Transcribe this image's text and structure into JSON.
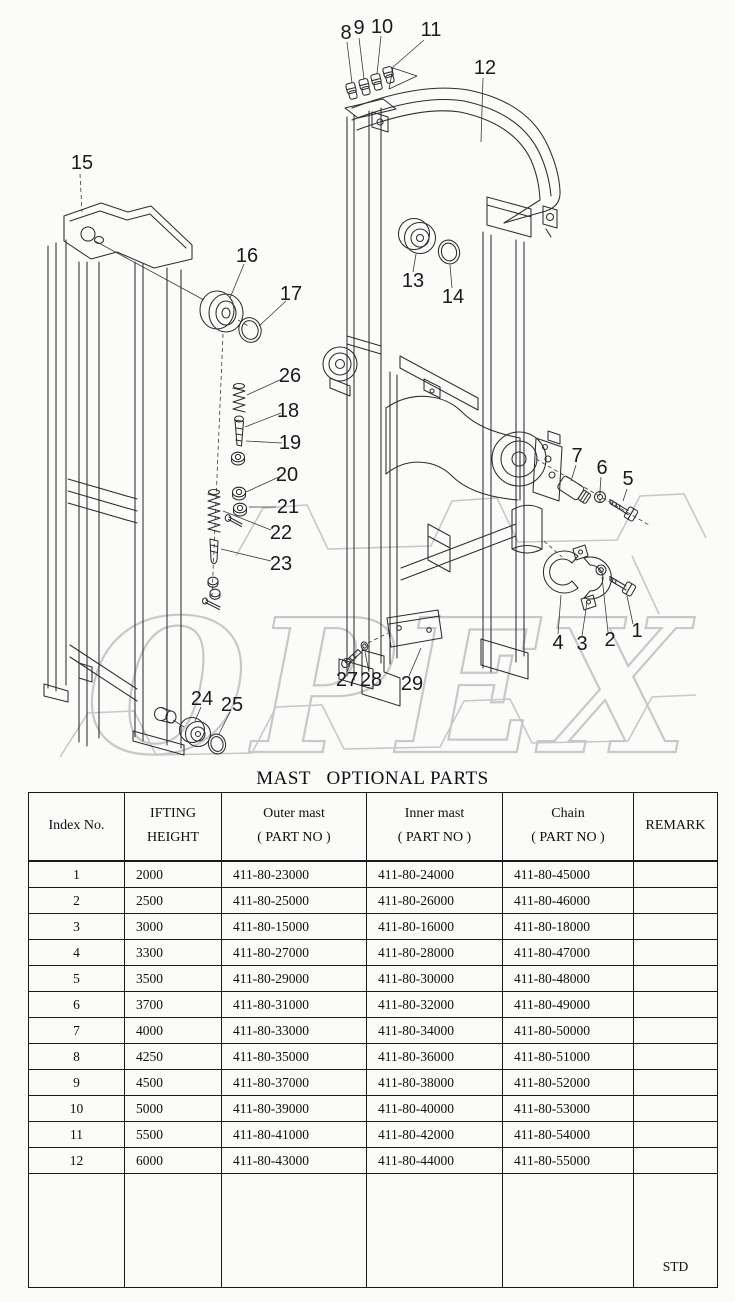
{
  "page": {
    "background": "#fbfbfa",
    "line_color": "#2d2d2d",
    "watermark_color": "#c8c8c8"
  },
  "diagram": {
    "watermark_text": "OPEX",
    "callouts": [
      "1",
      "2",
      "3",
      "4",
      "5",
      "6",
      "7",
      "8",
      "9",
      "10",
      "11",
      "12",
      "13",
      "14",
      "15",
      "16",
      "17",
      "18",
      "19",
      "20",
      "21",
      "22",
      "23",
      "24",
      "25",
      "26",
      "27",
      "28",
      "29"
    ]
  },
  "table": {
    "title": "MAST   OPTIONAL PARTS",
    "headers": {
      "index": "Index No.",
      "height1": "IFTING",
      "height2": "HEIGHT",
      "outer1": "Outer mast",
      "outer2": "( PART NO )",
      "inner1": "Inner mast",
      "inner2": "( PART NO )",
      "chain1": "Chain",
      "chain2": "( PART NO )",
      "remark": "REMARK"
    },
    "rows": [
      [
        "1",
        "2000",
        "411-80-23000",
        "411-80-24000",
        "411-80-45000"
      ],
      [
        "2",
        "2500",
        "411-80-25000",
        "411-80-26000",
        "411-80-46000"
      ],
      [
        "3",
        "3000",
        "411-80-15000",
        "411-80-16000",
        "411-80-18000"
      ],
      [
        "4",
        "3300",
        "411-80-27000",
        "411-80-28000",
        "411-80-47000"
      ],
      [
        "5",
        "3500",
        "411-80-29000",
        "411-80-30000",
        "411-80-48000"
      ],
      [
        "6",
        "3700",
        "411-80-31000",
        "411-80-32000",
        "411-80-49000"
      ],
      [
        "7",
        "4000",
        "411-80-33000",
        "411-80-34000",
        "411-80-50000"
      ],
      [
        "8",
        "4250",
        "411-80-35000",
        "411-80-36000",
        "411-80-51000"
      ],
      [
        "9",
        "4500",
        "411-80-37000",
        "411-80-38000",
        "411-80-52000"
      ],
      [
        "10",
        "5000",
        "411-80-39000",
        "411-80-40000",
        "411-80-53000"
      ],
      [
        "11",
        "5500",
        "411-80-41000",
        "411-80-42000",
        "411-80-54000"
      ],
      [
        "12",
        "6000",
        "411-80-43000",
        "411-80-44000",
        "411-80-55000"
      ]
    ],
    "std": "STD"
  }
}
